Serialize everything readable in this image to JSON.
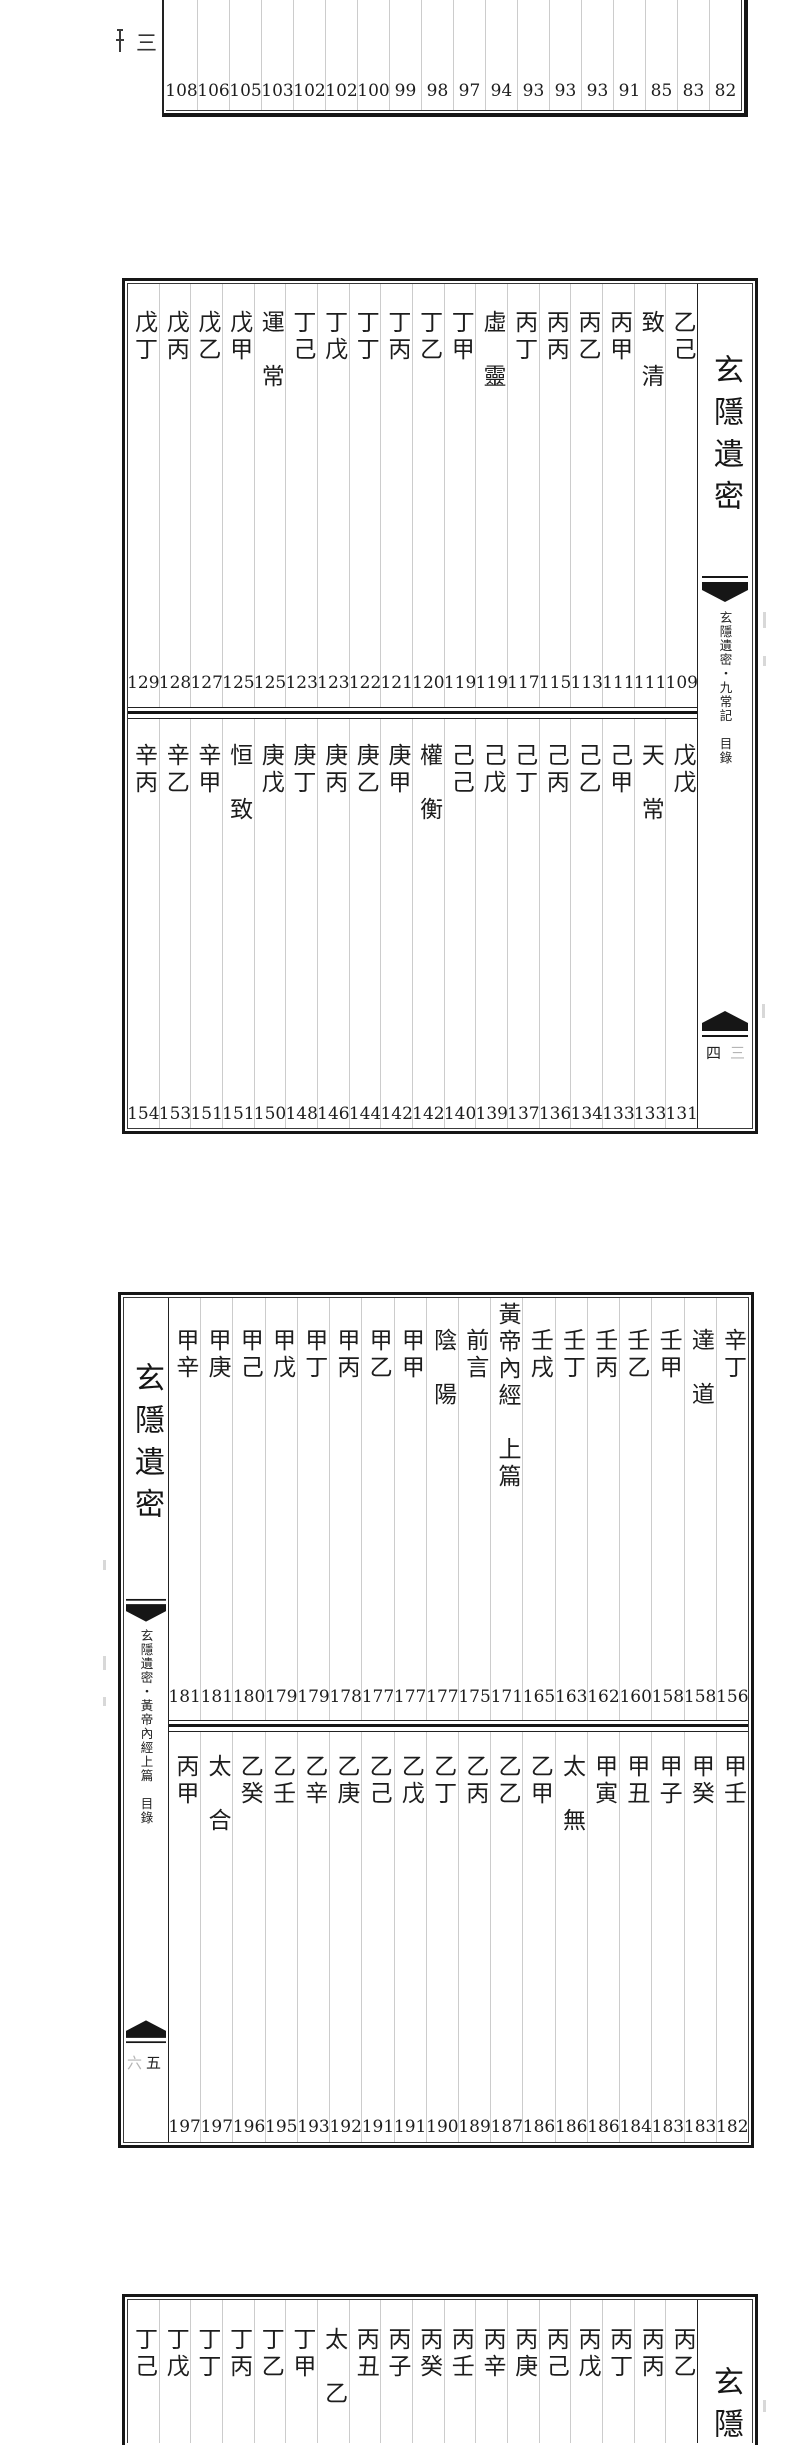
{
  "palette": {
    "paper": "#ffffff",
    "ink": "#1d1d1d",
    "frame_dark": "#161616",
    "frame_inner": "#3a3a3a",
    "column_rule": "#cccccc",
    "bleed_faint": "#b5b5b5"
  },
  "prev_page_edge": {
    "cut_numeral": "三"
  },
  "section_top_partial": {
    "page_numbers": [
      "108",
      "106",
      "105",
      "103",
      "102",
      "102",
      "100",
      "99",
      "98",
      "97",
      "94",
      "93",
      "93",
      "93",
      "91",
      "85",
      "83",
      "82"
    ]
  },
  "section_jiuchang": {
    "spine": {
      "book_title": "玄隱遺密",
      "running_title": "玄隱遺密・九常記　目錄",
      "folio": "四",
      "bleed_folio": "三"
    },
    "upper": [
      {
        "t": "戊丁",
        "n": "129"
      },
      {
        "t": "戊丙",
        "n": "128"
      },
      {
        "t": "戊乙",
        "n": "127"
      },
      {
        "t": "戊甲",
        "n": "125"
      },
      {
        "t": "運　常",
        "n": "125"
      },
      {
        "t": "丁己",
        "n": "123"
      },
      {
        "t": "丁戊",
        "n": "123"
      },
      {
        "t": "丁丁",
        "n": "122"
      },
      {
        "t": "丁丙",
        "n": "121"
      },
      {
        "t": "丁乙",
        "n": "120"
      },
      {
        "t": "丁甲",
        "n": "119"
      },
      {
        "t": "虛　靈",
        "n": "119"
      },
      {
        "t": "丙丁",
        "n": "117"
      },
      {
        "t": "丙丙",
        "n": "115"
      },
      {
        "t": "丙乙",
        "n": "113"
      },
      {
        "t": "丙甲",
        "n": "111"
      },
      {
        "t": "致　清",
        "n": "111"
      },
      {
        "t": "乙己",
        "n": "109"
      }
    ],
    "lower": [
      {
        "t": "辛丙",
        "n": "154"
      },
      {
        "t": "辛乙",
        "n": "153"
      },
      {
        "t": "辛甲",
        "n": "151"
      },
      {
        "t": "恒　致",
        "n": "151"
      },
      {
        "t": "庚戊",
        "n": "150"
      },
      {
        "t": "庚丁",
        "n": "148"
      },
      {
        "t": "庚丙",
        "n": "146"
      },
      {
        "t": "庚乙",
        "n": "144"
      },
      {
        "t": "庚甲",
        "n": "142"
      },
      {
        "t": "權　衡",
        "n": "142"
      },
      {
        "t": "己己",
        "n": "140"
      },
      {
        "t": "己戊",
        "n": "139"
      },
      {
        "t": "己丁",
        "n": "137"
      },
      {
        "t": "己丙",
        "n": "136"
      },
      {
        "t": "己乙",
        "n": "134"
      },
      {
        "t": "己甲",
        "n": "133"
      },
      {
        "t": "天　常",
        "n": "133"
      },
      {
        "t": "戊戊",
        "n": "131"
      }
    ]
  },
  "section_neijing": {
    "spine": {
      "book_title": "玄隱遺密",
      "running_title": "玄隱遺密・黃帝內經上篇　目錄",
      "folio": "五",
      "bleed_folio": "六"
    },
    "upper": [
      {
        "t": "甲辛",
        "n": "181"
      },
      {
        "t": "甲庚",
        "n": "181"
      },
      {
        "t": "甲己",
        "n": "180"
      },
      {
        "t": "甲戊",
        "n": "179"
      },
      {
        "t": "甲丁",
        "n": "179"
      },
      {
        "t": "甲丙",
        "n": "178"
      },
      {
        "t": "甲乙",
        "n": "177"
      },
      {
        "t": "甲甲",
        "n": "177"
      },
      {
        "t": "陰　陽",
        "n": "177"
      },
      {
        "t": "前言",
        "n": "175"
      },
      {
        "t": "黃帝內經　上篇",
        "n": "171",
        "cls": "raised"
      },
      {
        "t": "壬戌",
        "n": "165"
      },
      {
        "t": "壬丁",
        "n": "163"
      },
      {
        "t": "壬丙",
        "n": "162"
      },
      {
        "t": "壬乙",
        "n": "160"
      },
      {
        "t": "壬甲",
        "n": "158"
      },
      {
        "t": "達　道",
        "n": "158"
      },
      {
        "t": "辛丁",
        "n": "156"
      }
    ],
    "lower": [
      {
        "t": "丙甲",
        "n": "197"
      },
      {
        "t": "太　合",
        "n": "197"
      },
      {
        "t": "乙癸",
        "n": "196"
      },
      {
        "t": "乙壬",
        "n": "195"
      },
      {
        "t": "乙辛",
        "n": "193"
      },
      {
        "t": "乙庚",
        "n": "192"
      },
      {
        "t": "乙己",
        "n": "191"
      },
      {
        "t": "乙戊",
        "n": "191"
      },
      {
        "t": "乙丁",
        "n": "190"
      },
      {
        "t": "乙丙",
        "n": "189"
      },
      {
        "t": "乙乙",
        "n": "187"
      },
      {
        "t": "乙甲",
        "n": "186"
      },
      {
        "t": "太　無",
        "n": "186"
      },
      {
        "t": "甲寅",
        "n": "186"
      },
      {
        "t": "甲丑",
        "n": "184"
      },
      {
        "t": "甲子",
        "n": "183"
      },
      {
        "t": "甲癸",
        "n": "183"
      },
      {
        "t": "甲壬",
        "n": "182"
      }
    ]
  },
  "section_bottom_partial": {
    "spine": {
      "book_title_visible": "玄隱"
    },
    "upper": [
      {
        "t": "丁己"
      },
      {
        "t": "丁戊"
      },
      {
        "t": "丁丁"
      },
      {
        "t": "丁丙"
      },
      {
        "t": "丁乙"
      },
      {
        "t": "丁甲"
      },
      {
        "t": "太　乙"
      },
      {
        "t": "丙丑"
      },
      {
        "t": "丙子"
      },
      {
        "t": "丙癸"
      },
      {
        "t": "丙壬"
      },
      {
        "t": "丙辛"
      },
      {
        "t": "丙庚"
      },
      {
        "t": "丙己"
      },
      {
        "t": "丙戊"
      },
      {
        "t": "丙丁"
      },
      {
        "t": "丙丙"
      },
      {
        "t": "丙乙"
      }
    ]
  }
}
